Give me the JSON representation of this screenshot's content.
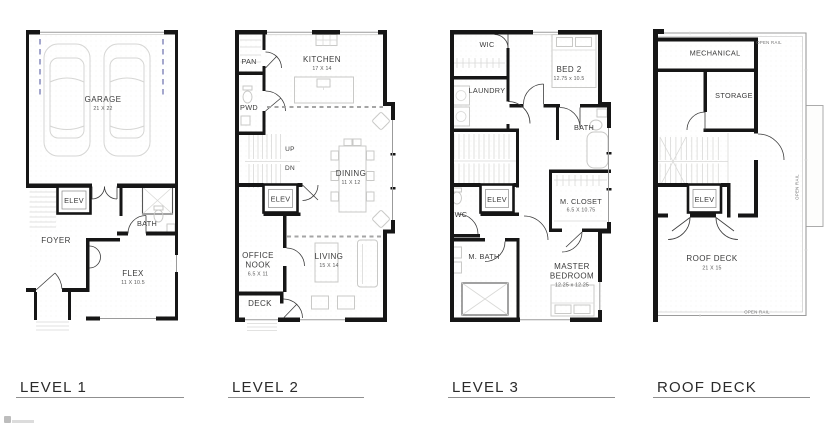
{
  "plans": {
    "level1": {
      "title": "LEVEL 1",
      "garage": "GARAGE",
      "garage_dims": "21 X 22",
      "elev": "ELEV",
      "bath": "BATH",
      "foyer": "FOYER",
      "flex": "FLEX",
      "flex_dims": "11 X 10.5"
    },
    "level2": {
      "title": "LEVEL 2",
      "pan": "PAN",
      "kitchen": "KITCHEN",
      "kitchen_dims": "17 X 14",
      "pwd": "PWD",
      "up": "UP",
      "dn": "DN",
      "dining": "DINING",
      "dining_dims": "11 X 12",
      "elev": "ELEV",
      "office_line1": "OFFICE",
      "office_line2": "NOOK",
      "office_dims": "6.5 X 11",
      "living": "LIVING",
      "living_dims": "15 X 14",
      "deck": "DECK"
    },
    "level3": {
      "title": "LEVEL 3",
      "wic": "WIC",
      "bed2": "BED 2",
      "bed2_dims": "12.75 x 10.5",
      "laundry": "LAUNDRY",
      "bath": "BATH",
      "elev": "ELEV",
      "wc": "WC",
      "m_closet": "M. CLOSET",
      "m_closet_dims": "6.5 X 10.75",
      "m_bath": "M. BATH",
      "master_line1": "MASTER",
      "master_line2": "BEDROOM",
      "master_dims": "12.25 x 12.25"
    },
    "roof_deck": {
      "title": "ROOF DECK",
      "mechanical": "MECHANICAL",
      "storage": "STORAGE",
      "elev": "ELEV",
      "roof_deck": "ROOF DECK",
      "roof_deck_dims": "21 X 15",
      "open_rail_top": "OPEN RAIL",
      "open_rail_right": "OPEN RAIL",
      "open_rail_bottom": "OPEN RAIL"
    }
  },
  "colors": {
    "wall": "#161616",
    "fixture": "#c9c9c7",
    "garage_door_dash": "#7d82b8",
    "label": "#3b3b3b"
  }
}
